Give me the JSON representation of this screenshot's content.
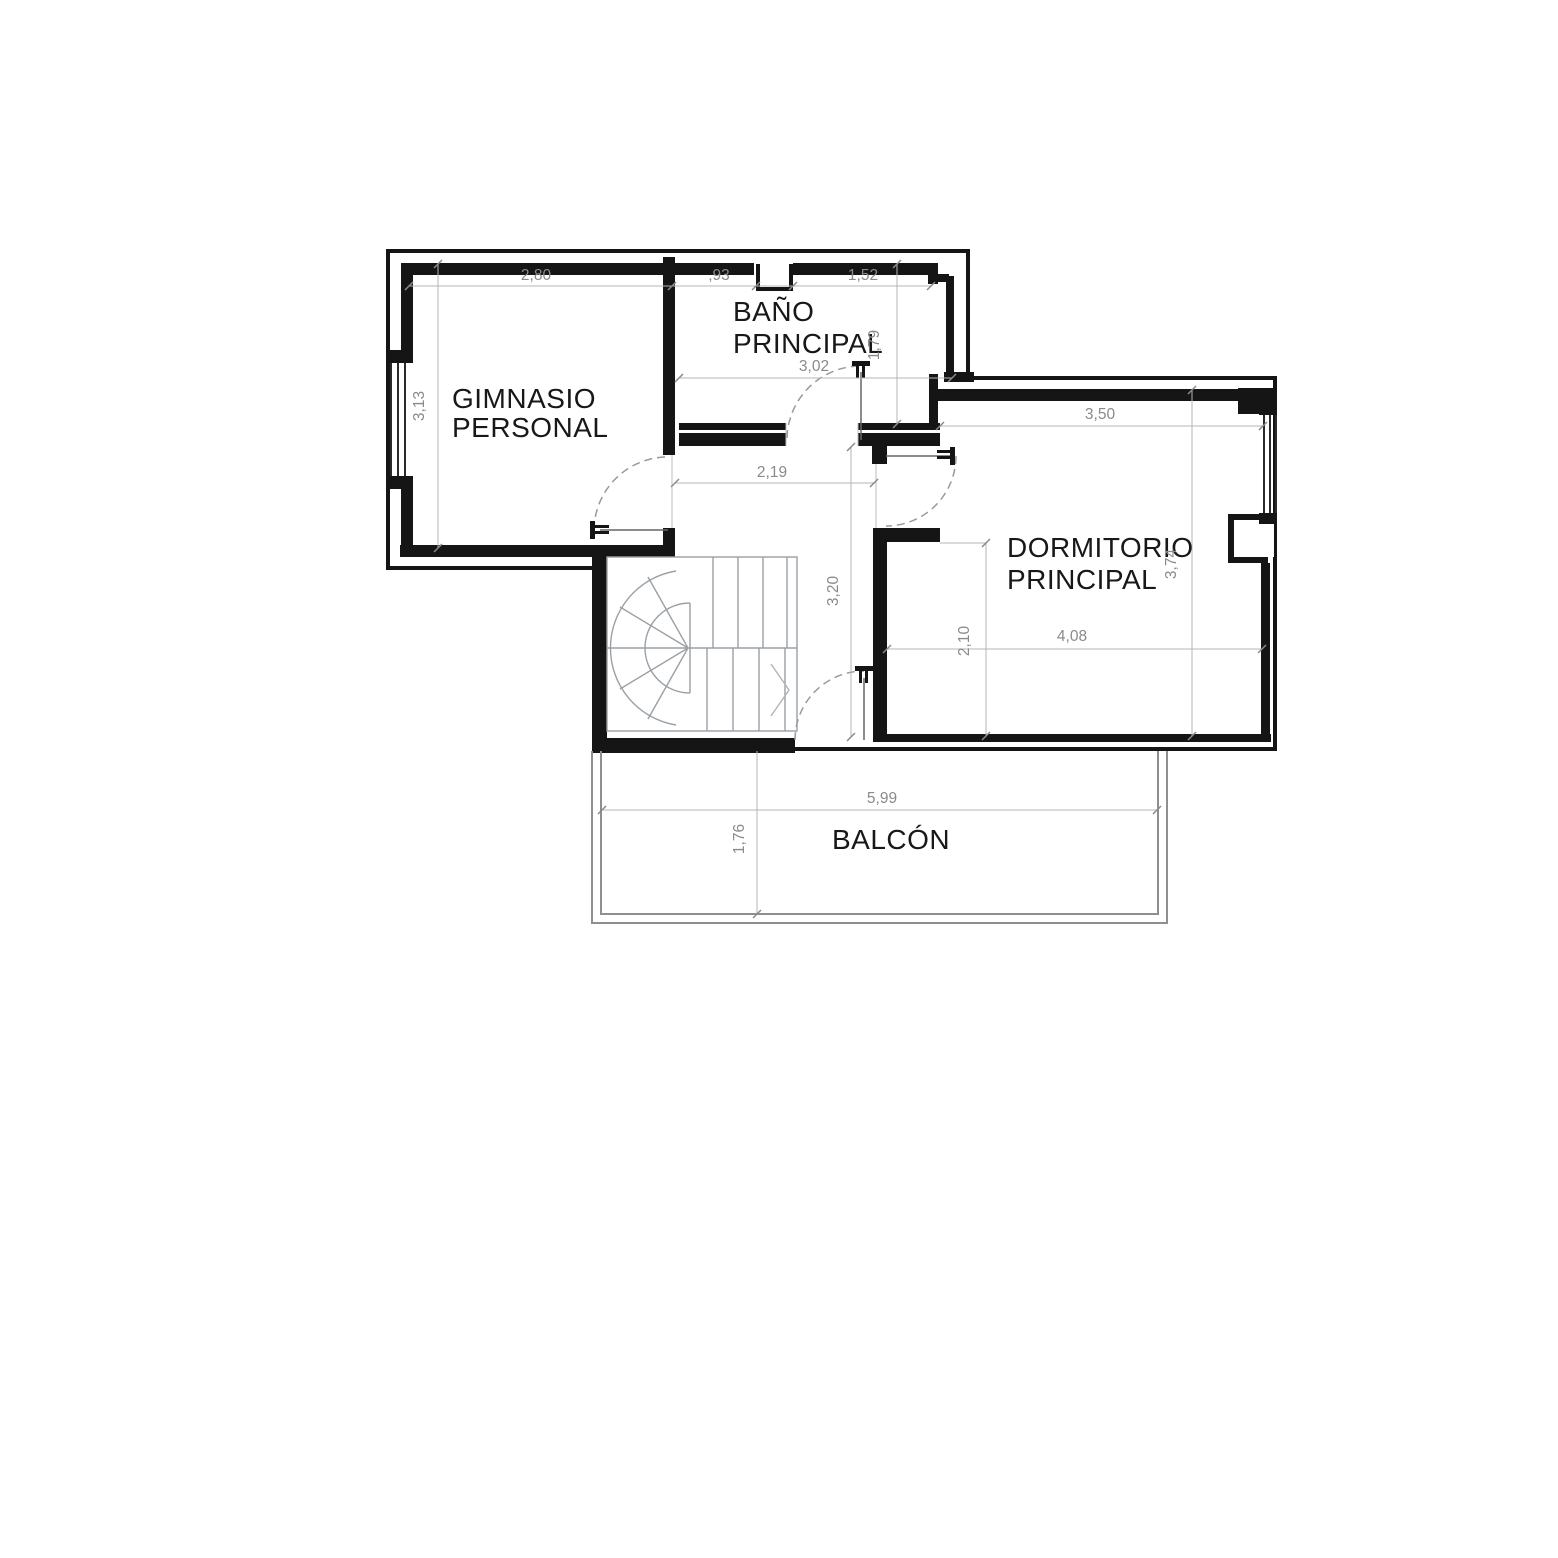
{
  "labels": {
    "gym1": "GIMNASIO",
    "gym2": "PERSONAL",
    "bath1": "BAÑO",
    "bath2": "PRINCIPAL",
    "bed1": "DORMITORIO",
    "bed2": "PRINCIPAL",
    "balcony": "BALCÓN"
  },
  "dims": {
    "gym_w": "2,80",
    "gym_h": "3,13",
    "bath_seg_left": ",93",
    "bath_seg_right": "1,52",
    "bath_h": "1,79",
    "bath_w": "3,02",
    "hall_w": "2,19",
    "hall_h": "3,20",
    "bed_top": "3,50",
    "bed_h": "3,74",
    "bed_w": "4,08",
    "bed_partial_h": "2,10",
    "balcony_w": "5,99",
    "balcony_d": "1,76"
  }
}
